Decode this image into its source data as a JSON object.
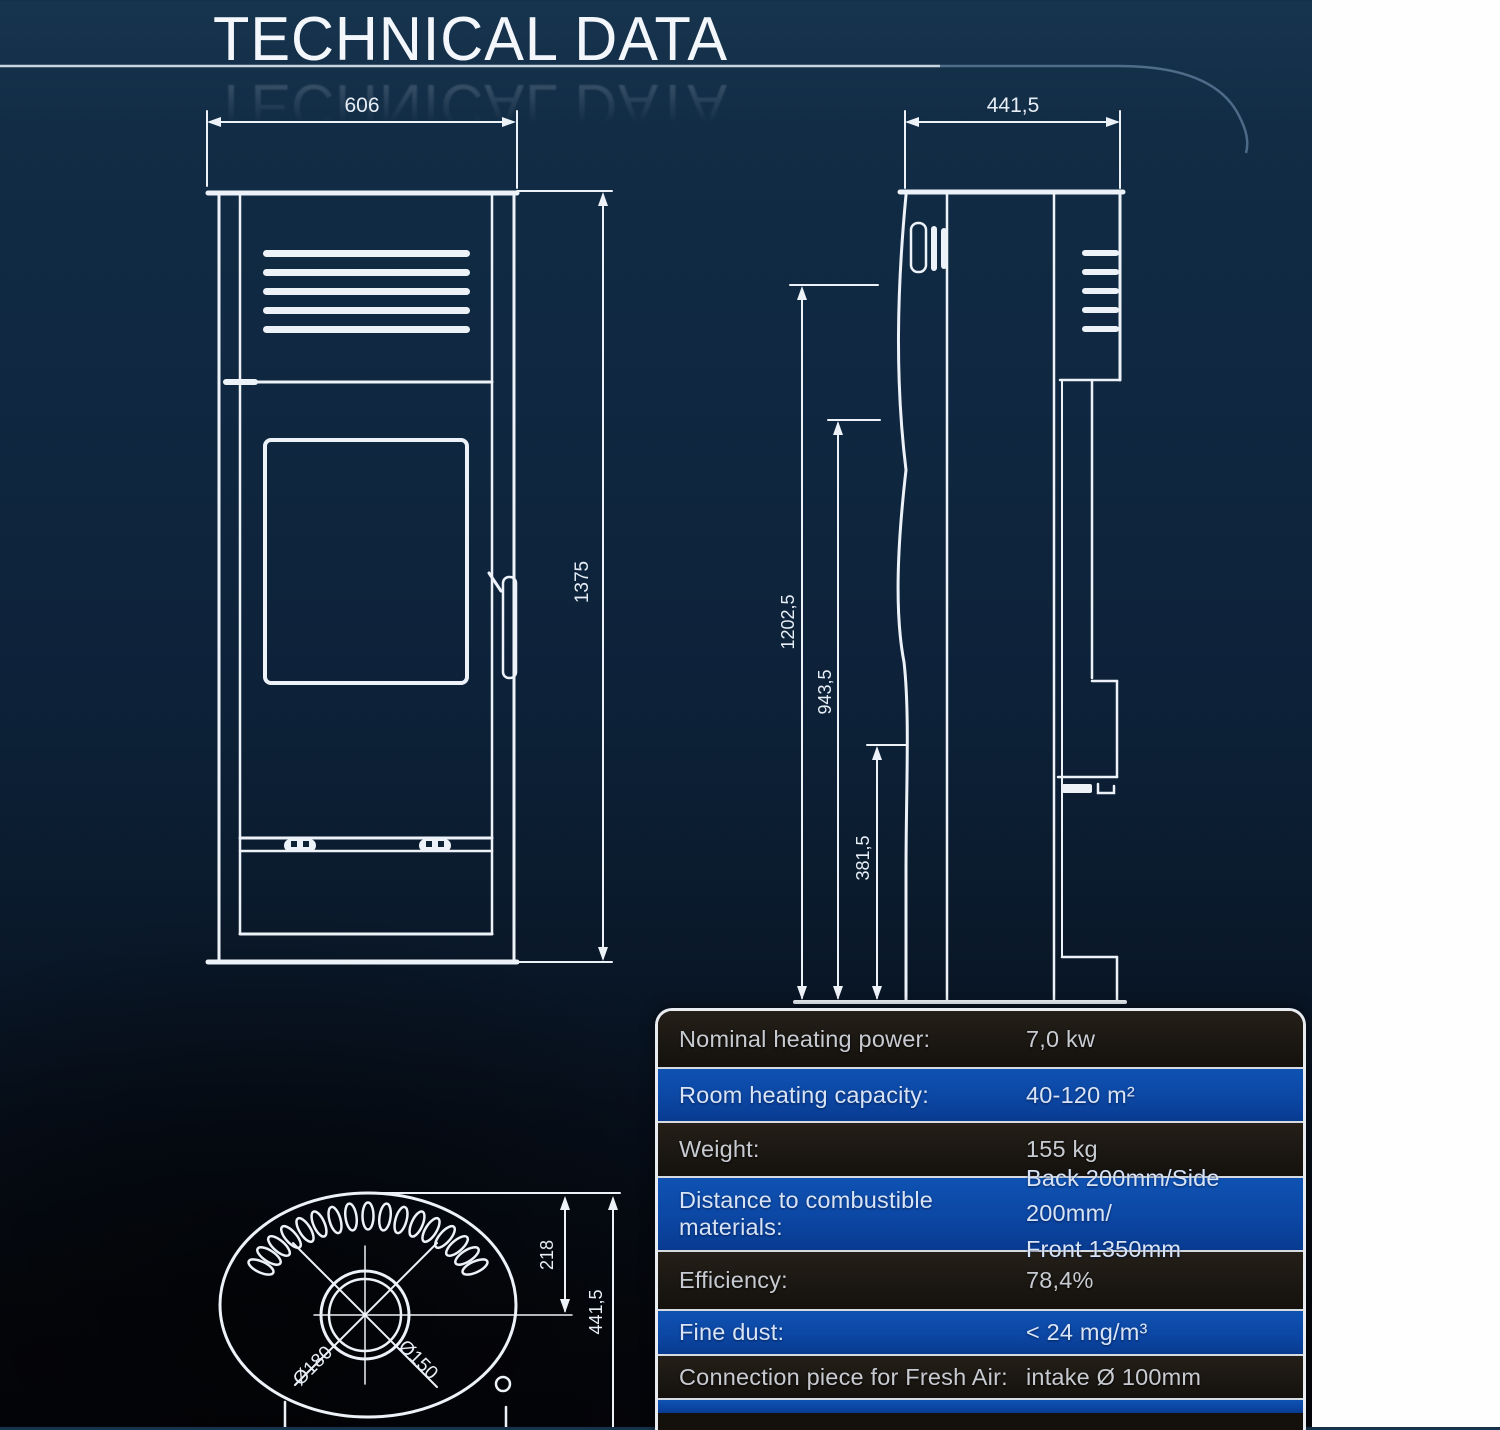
{
  "header": {
    "title": "TECHNICAL DATA"
  },
  "drawings": {
    "front_view": {
      "width": "606",
      "height": "1375"
    },
    "side_view": {
      "depth": "441,5",
      "height_total": "1202,5",
      "height_mid": "943,5",
      "height_low": "381,5"
    },
    "top_view": {
      "flue_center_offset": "218",
      "depth": "441,5",
      "flue_outer_dia": "Ø180",
      "flue_inner_dia": "Ø150"
    }
  },
  "table": {
    "rows": [
      {
        "label": "Nominal heating power:",
        "value": "7,0 kw"
      },
      {
        "label": "Room heating capacity:",
        "value": "40-120 m²"
      },
      {
        "label": "Weight:",
        "value": "155 kg"
      },
      {
        "label": "Distance to combustible materials:",
        "value": "Back 200mm/Side 200mm/",
        "value2": "Front 1350mm"
      },
      {
        "label": "Efficiency:",
        "value": "78,4%"
      },
      {
        "label": "Fine dust:",
        "value": "< 24 mg/m³"
      },
      {
        "label": "Connection piece for Fresh Air:",
        "value": "intake Ø 100mm"
      }
    ]
  }
}
